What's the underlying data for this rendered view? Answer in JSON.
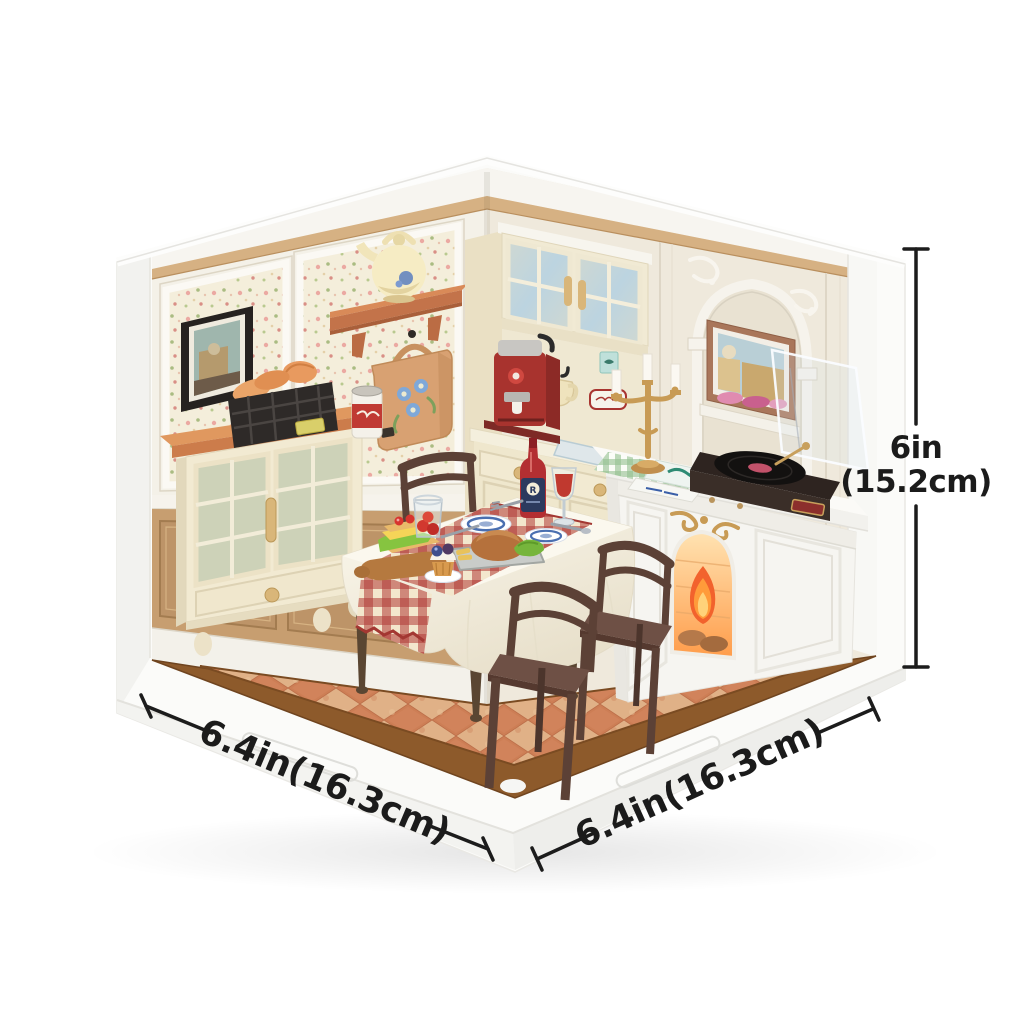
{
  "annotations": {
    "height": {
      "value_in": "6in",
      "value_cm": "(15.2cm)"
    },
    "depth_left": {
      "value": "6.4in(16.3cm)"
    },
    "width_right": {
      "value": "6.4in(16.3cm)"
    }
  },
  "palette": {
    "background": "#ffffff",
    "dimension_line": "#1c1c1c",
    "wall_panel_cream": "#efe9dc",
    "wallpaper_cream": "#f4eedb",
    "wood_trim": "#d6b183",
    "wainscot_wood": "#c79e70",
    "floor_tile_dark": "#cd7e55",
    "floor_tile_light": "#e0b187",
    "floor_border_brown": "#8d5a2b",
    "furniture_cream": "#f2ead2",
    "terracotta_top": "#d98e5f",
    "chair_brown": "#5c4136",
    "gingham_red": "#b03b36",
    "fire_orange": "#ff8a2a",
    "candelabra_gold": "#c89b55",
    "espresso_machine_red": "#a8332e"
  },
  "scene": {
    "kind": "isometric miniature room render (DIY dollhouse kit) with dimension lines",
    "room": "dining room",
    "objects": [
      "floral wallpaper panels",
      "black framed picture",
      "wall shelf with teapot",
      "hanging floral tote bag",
      "glass-door sideboard",
      "wire bread basket",
      "jam jar",
      "corner hutch cabinet with glass doors",
      "red espresso machine",
      "hanging cream mugs",
      "dining table with white tablecloth",
      "red gingham table runner",
      "roast dinner tray",
      "blue rim plates",
      "sandwich on cutting board",
      "berry cupcake",
      "wine bottle",
      "wine glass",
      "glass of strawberries",
      "three wooden chairs",
      "white fireplace with fire",
      "gold candelabra with candles",
      "record player with open clear lid",
      "arched wall niche with framed art",
      "checkered terracotta tile floor",
      "white display base"
    ]
  }
}
